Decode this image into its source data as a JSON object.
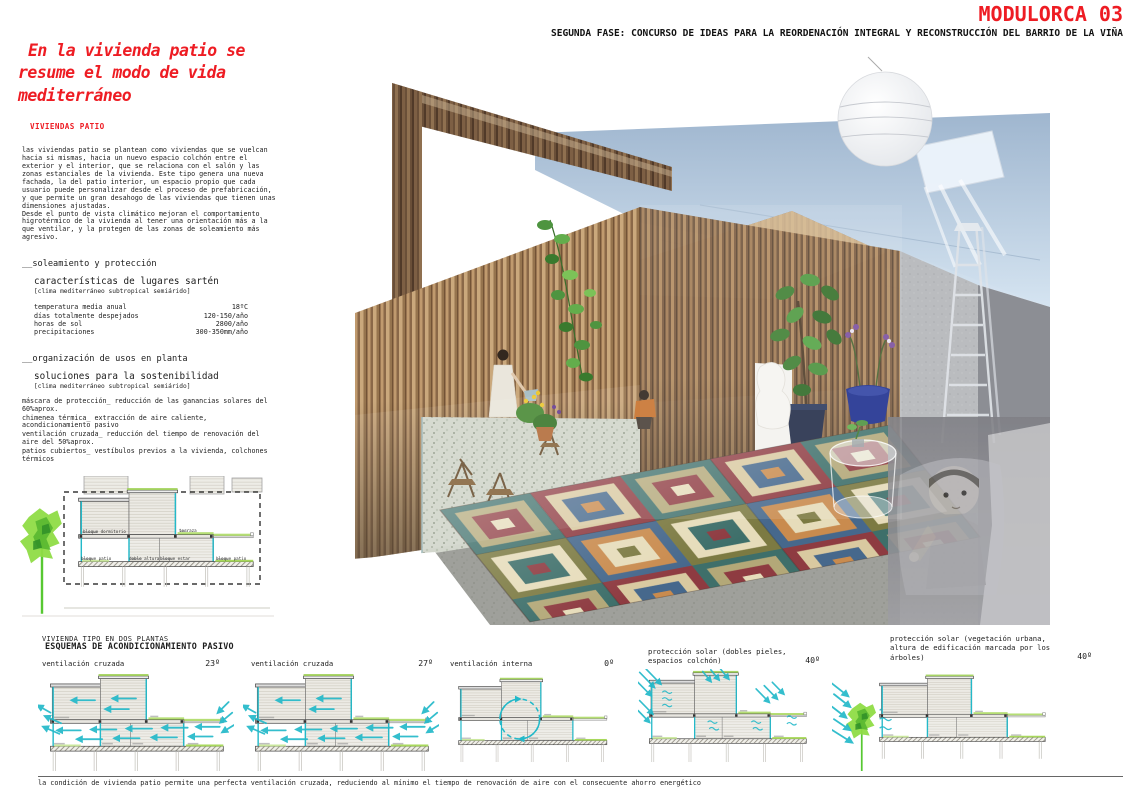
{
  "header": {
    "title": "MODULORCA 03",
    "subtitle": "SEGUNDA FASE: CONCURSO DE IDEAS PARA LA REORDENACIÓN INTEGRAL Y RECONSTRUCCIÓN DEL BARRIO DE LA VIÑA"
  },
  "left_column": {
    "headline": "En la vivienda patio se resume el modo de vida mediterráneo",
    "section_label": "VIVIENDAS PATIO",
    "intro_paragraphs": {
      "p1": "las viviendas patio se plantean como viviendas que se vuelcan hacia si mismas, hacia un nuevo espacio colchón entre el exterior y el interior, que se relaciona con el salón y las zonas estanciales de la vivienda. Este tipo genera una nueva fachada, la del patio interior, un espacio propio que cada usuario puede personalizar desde el proceso de prefabricación, y que permite un gran desahogo de las viviendas que tienen unas dimensiones ajustadas.",
      "p2": "Desde el punto de vista climático mejoran el comportamiento higrotérmico de la vivienda al tener una orientación más a la que ventilar, y la protegen de las zonas de soleamiento más agresivo."
    },
    "soleamiento": {
      "title": "__soleamiento y protección",
      "subtitle": "características de lugares sartén",
      "note": "[clima mediterráneo subtropical semiárido]",
      "stats": [
        {
          "label": "temperatura media anual",
          "value": "18ºC"
        },
        {
          "label": "días totalmente despejados",
          "value": "120-150/año"
        },
        {
          "label": "horas de sol",
          "value": "2800/año"
        },
        {
          "label": "precipitaciones",
          "value": "300-350mm/año"
        }
      ]
    },
    "organizacion": {
      "title": "__organización de usos en planta",
      "subtitle": "soluciones para la sostenibilidad",
      "note": "[clima mediterráneo subtropical semiárido]",
      "items": [
        "máscara de protección_ reducción de las ganancias solares del 60%aprox.",
        "chimenea térmica_ extracción de aire caliente, acondicionamiento pasivo",
        "ventilación cruzada_ reducción del tiempo de renovación del aire del 50%aprox.",
        "patios cubiertos_ vestíbulos previos a la vivienda, colchones térmicos"
      ]
    },
    "diagram_labels": {
      "dormitorio": "bloque dormitorio",
      "terraza": "terraza",
      "patio": "bloque patio",
      "doble": "doble altura",
      "estar": "bloque estar",
      "patio2": "bloque patio"
    },
    "diagram_caption": "VIVIENDA TIPO EN DOS PLANTAS"
  },
  "schemes": {
    "title": "ESQUEMAS DE ACONDICIONAMIENTO PASIVO",
    "items": [
      {
        "label": "ventilación cruzada",
        "angle": "23º"
      },
      {
        "label": "ventilación cruzada",
        "angle": "27º"
      },
      {
        "label": "ventilación interna",
        "angle": "0º"
      },
      {
        "label": "protección solar (dobles pieles, espacios colchón)",
        "angle": "40º"
      },
      {
        "label": "protección solar (vegetación urbana, altura de edificación marcada por los árboles)",
        "angle": "40º"
      }
    ],
    "footnote": "la condición de vivienda patio permite una perfecta ventilación cruzada, reduciendo al mínimo el tiempo de renovación de aire con el consecuente ahorro energético"
  },
  "colors": {
    "accent_red": "#ee1c23",
    "arrow_cyan": "#23b9c9",
    "vegetation_green": "#8fdc46"
  }
}
